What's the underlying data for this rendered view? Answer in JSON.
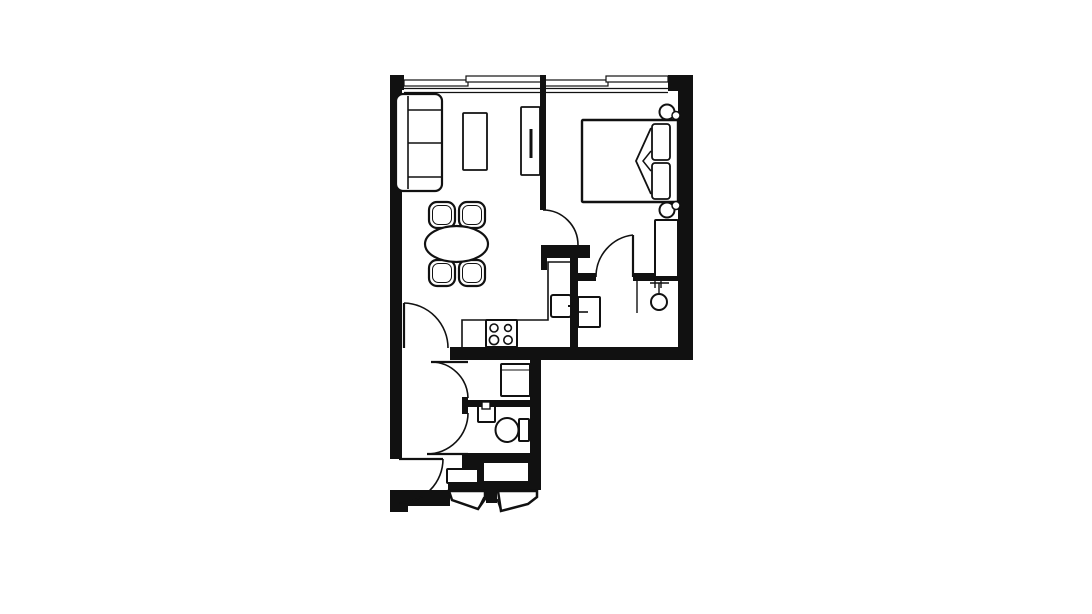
{
  "canvas": {
    "width": 1092,
    "height": 614,
    "background": "#ffffff",
    "ink": "#111111"
  },
  "plan": {
    "description": "one-bedroom apartment floor plan, black line drawing on white",
    "rooms": [
      "living-dining",
      "kitchen",
      "bedroom",
      "closet",
      "utility",
      "bathroom",
      "hall-entry"
    ],
    "elements": [
      {
        "name": "window-band",
        "t": "hole",
        "x": 404,
        "y": 75,
        "w": 264,
        "h": 18
      },
      {
        "name": "window-inner-line-1",
        "t": "line",
        "x1": 404,
        "y1": 88.5,
        "x2": 668,
        "y2": 88.5,
        "sw": 1.2
      },
      {
        "name": "window-inner-line-2",
        "t": "line",
        "x1": 404,
        "y1": 92.5,
        "x2": 668,
        "y2": 92.5,
        "sw": 1.2
      },
      {
        "name": "window-frame-living-1",
        "t": "frame",
        "x": 404,
        "y": 80,
        "w": 64,
        "h": 6,
        "sw": 1.2
      },
      {
        "name": "window-frame-living-2",
        "t": "frame",
        "x": 466,
        "y": 76,
        "w": 77,
        "h": 6,
        "sw": 1.2
      },
      {
        "name": "window-frame-bedroom-1",
        "t": "frame",
        "x": 545,
        "y": 80,
        "w": 63,
        "h": 6,
        "sw": 1.2
      },
      {
        "name": "window-frame-bedroom-2",
        "t": "frame",
        "x": 606,
        "y": 76,
        "w": 62,
        "h": 6,
        "sw": 1.2
      },
      {
        "name": "wall-top-left-corner",
        "t": "wall",
        "x": 390,
        "y": 75,
        "w": 14,
        "h": 15
      },
      {
        "name": "wall-top-right-corner",
        "t": "wall",
        "x": 668,
        "y": 75,
        "w": 25,
        "h": 16
      },
      {
        "name": "wall-left",
        "t": "wall",
        "x": 390,
        "y": 75,
        "w": 12,
        "h": 384
      },
      {
        "name": "wall-right",
        "t": "wall",
        "x": 678,
        "y": 75,
        "w": 15,
        "h": 285
      },
      {
        "name": "wall-upper-bottom",
        "t": "wall",
        "x": 450,
        "y": 347,
        "w": 243,
        "h": 13
      },
      {
        "name": "wall-room-divider",
        "t": "wall",
        "x": 540,
        "y": 75,
        "w": 6,
        "h": 135
      },
      {
        "name": "wall-kitchen-top",
        "t": "wall",
        "x": 541,
        "y": 245,
        "w": 49,
        "h": 13
      },
      {
        "name": "wall-kitchen-top-leg",
        "t": "wall",
        "x": 541,
        "y": 245,
        "w": 6,
        "h": 25
      },
      {
        "name": "wall-kitchen-partition",
        "t": "wall",
        "x": 570,
        "y": 258,
        "w": 8,
        "h": 94
      },
      {
        "name": "wall-closet-left",
        "t": "wall",
        "x": 578,
        "y": 273,
        "w": 18,
        "h": 8
      },
      {
        "name": "wall-closet-right",
        "t": "wall",
        "x": 633,
        "y": 273,
        "w": 45,
        "h": 8
      },
      {
        "name": "wall-hall-stub",
        "t": "wall",
        "x": 462,
        "y": 397,
        "w": 6,
        "h": 17
      },
      {
        "name": "wall-bath-divider",
        "t": "wall",
        "x": 468,
        "y": 400,
        "w": 62,
        "h": 7
      },
      {
        "name": "wall-bath-bottom",
        "t": "wall",
        "x": 462,
        "y": 453,
        "w": 78,
        "h": 10
      },
      {
        "name": "wall-bath-bottom-ext",
        "t": "wall",
        "x": 462,
        "y": 453,
        "w": 16,
        "h": 15
      },
      {
        "name": "wall-shaft-block",
        "t": "wall",
        "x": 476,
        "y": 453,
        "w": 64,
        "h": 37
      },
      {
        "name": "shaft-void",
        "t": "hole",
        "x": 484,
        "y": 463,
        "w": 44,
        "h": 18
      },
      {
        "name": "wall-closet-top-bar",
        "t": "wall",
        "x": 448,
        "y": 482,
        "w": 92,
        "h": 8
      },
      {
        "name": "wall-closet-divider",
        "t": "wall",
        "x": 486,
        "y": 482,
        "w": 11,
        "h": 21
      },
      {
        "name": "wall-bottom",
        "t": "wall",
        "x": 390,
        "y": 490,
        "w": 60,
        "h": 16
      },
      {
        "name": "wall-bottom-left-corner",
        "t": "wall",
        "x": 390,
        "y": 497,
        "w": 18,
        "h": 15
      },
      {
        "name": "wall-lower-right",
        "t": "wall",
        "x": 530,
        "y": 360,
        "w": 11,
        "h": 130
      },
      {
        "name": "sofa-body",
        "t": "rect",
        "x": 396,
        "y": 94,
        "w": 46,
        "h": 97,
        "r": 7,
        "sw": 2.2
      },
      {
        "name": "sofa-back-line",
        "t": "line",
        "x1": 408,
        "y1": 96,
        "x2": 408,
        "y2": 189,
        "sw": 1.6
      },
      {
        "name": "sofa-armrest-top",
        "t": "line",
        "x1": 408,
        "y1": 110,
        "x2": 441,
        "y2": 110,
        "sw": 1.6
      },
      {
        "name": "sofa-cushion-split",
        "t": "line",
        "x1": 408,
        "y1": 143,
        "x2": 441,
        "y2": 143,
        "sw": 1.6
      },
      {
        "name": "sofa-armrest-bottom",
        "t": "line",
        "x1": 408,
        "y1": 177,
        "x2": 441,
        "y2": 177,
        "sw": 1.6
      },
      {
        "name": "coffee-table",
        "t": "rect",
        "x": 463,
        "y": 113,
        "w": 24,
        "h": 57,
        "r": 1,
        "sw": 1.8
      },
      {
        "name": "tv-unit",
        "t": "rect",
        "x": 521,
        "y": 107,
        "w": 19,
        "h": 68,
        "r": 1,
        "sw": 1.8
      },
      {
        "name": "tv-screen",
        "t": "line",
        "x1": 531,
        "y1": 129,
        "x2": 531,
        "y2": 158,
        "sw": 3
      },
      {
        "name": "dining-chair-outer-tl",
        "t": "rect",
        "x": 429,
        "y": 202,
        "w": 26,
        "h": 26,
        "r": 8,
        "sw": 2.2
      },
      {
        "name": "dining-chair-inner-tl",
        "t": "rect",
        "x": 432.5,
        "y": 205.5,
        "w": 19,
        "h": 19,
        "r": 6,
        "sw": 1
      },
      {
        "name": "dining-chair-outer-tr",
        "t": "rect",
        "x": 459,
        "y": 202,
        "w": 26,
        "h": 26,
        "r": 8,
        "sw": 2.2
      },
      {
        "name": "dining-chair-inner-tr",
        "t": "rect",
        "x": 462.5,
        "y": 205.5,
        "w": 19,
        "h": 19,
        "r": 6,
        "sw": 1
      },
      {
        "name": "dining-chair-outer-bl",
        "t": "rect",
        "x": 429,
        "y": 260,
        "w": 26,
        "h": 26,
        "r": 8,
        "sw": 2.2
      },
      {
        "name": "dining-chair-inner-bl",
        "t": "rect",
        "x": 432.5,
        "y": 263.5,
        "w": 19,
        "h": 19,
        "r": 6,
        "sw": 1
      },
      {
        "name": "dining-chair-outer-br",
        "t": "rect",
        "x": 459,
        "y": 260,
        "w": 26,
        "h": 26,
        "r": 8,
        "sw": 2.2
      },
      {
        "name": "dining-chair-inner-br",
        "t": "rect",
        "x": 462.5,
        "y": 263.5,
        "w": 19,
        "h": 19,
        "r": 6,
        "sw": 1
      },
      {
        "name": "dining-table",
        "t": "ellipse",
        "cx": 456.5,
        "cy": 244,
        "rx": 31.5,
        "ry": 18,
        "sw": 2.2
      },
      {
        "name": "bed",
        "t": "rect",
        "x": 582,
        "y": 120,
        "w": 96,
        "h": 82,
        "r": 1,
        "sw": 2.4
      },
      {
        "name": "bed-pillow-top",
        "t": "rect",
        "x": 652,
        "y": 124,
        "w": 18,
        "h": 36,
        "r": 3,
        "sw": 1.8
      },
      {
        "name": "bed-pillow-bottom",
        "t": "rect",
        "x": 652,
        "y": 163,
        "w": 18,
        "h": 36,
        "r": 3,
        "sw": 1.8
      },
      {
        "name": "bed-duvet-fold",
        "t": "path",
        "d": "M651,128 L636,161 L651,194",
        "sw": 1.8
      },
      {
        "name": "bed-duvet-fold-small",
        "t": "path",
        "d": "M651,151 L643,161 L651,171",
        "sw": 1.5
      },
      {
        "name": "bedside-lamp-top",
        "t": "circle",
        "cx": 667,
        "cy": 112,
        "rx": 7.5,
        "sw": 2
      },
      {
        "name": "bedside-lamp-top-small",
        "t": "circle",
        "cx": 676,
        "cy": 115.5,
        "rx": 4,
        "sw": 1.5
      },
      {
        "name": "bedside-lamp-bottom",
        "t": "circle",
        "cx": 667,
        "cy": 210,
        "rx": 7.5,
        "sw": 2
      },
      {
        "name": "bedside-lamp-bottom-small",
        "t": "circle",
        "cx": 676,
        "cy": 205.5,
        "rx": 4,
        "sw": 1.5
      },
      {
        "name": "bedroom-dresser",
        "t": "rect",
        "x": 655,
        "y": 220,
        "w": 23,
        "h": 57,
        "r": 1,
        "sw": 2
      },
      {
        "name": "kitchen-counter-edge",
        "t": "path",
        "d": "M462,349 L462,320 L548,320 L548,262 L570,262",
        "sw": 1.6
      },
      {
        "name": "kitchen-stove",
        "t": "rect",
        "x": 486,
        "y": 320,
        "w": 31,
        "h": 27,
        "r": 1,
        "sw": 2
      },
      {
        "name": "stove-burner-tl",
        "t": "circle",
        "cx": 494,
        "cy": 328,
        "rx": 4,
        "sw": 1.6
      },
      {
        "name": "stove-burner-tr",
        "t": "circle",
        "cx": 508,
        "cy": 328,
        "rx": 3.4,
        "sw": 1.6
      },
      {
        "name": "stove-burner-bl",
        "t": "circle",
        "cx": 494,
        "cy": 340,
        "rx": 4.6,
        "sw": 1.6
      },
      {
        "name": "stove-burner-br",
        "t": "circle",
        "cx": 508,
        "cy": 340,
        "rx": 4.2,
        "sw": 1.6
      },
      {
        "name": "kitchen-sink",
        "t": "rect",
        "x": 551,
        "y": 295,
        "w": 20,
        "h": 22,
        "r": 2,
        "sw": 2
      },
      {
        "name": "kitchen-sink-tap",
        "t": "line",
        "x1": 568,
        "y1": 306,
        "x2": 576,
        "y2": 306,
        "sw": 2
      },
      {
        "name": "kitchen-sink-tap-tick",
        "t": "line",
        "x1": 572,
        "y1": 302,
        "x2": 572,
        "y2": 310,
        "sw": 1.2
      },
      {
        "name": "washing-machine",
        "t": "rect",
        "x": 578,
        "y": 297,
        "w": 22,
        "h": 30,
        "r": 1,
        "sw": 2
      },
      {
        "name": "washing-machine-handle",
        "t": "line",
        "x1": 579,
        "y1": 312,
        "x2": 588,
        "y2": 312,
        "sw": 1.6
      },
      {
        "name": "closet-jamb-line",
        "t": "line",
        "x1": 637,
        "y1": 281,
        "x2": 637,
        "y2": 313,
        "sw": 1.4
      },
      {
        "name": "closet-rail-bar",
        "t": "line",
        "x1": 650,
        "y1": 283,
        "x2": 669,
        "y2": 283,
        "sw": 1.4
      },
      {
        "name": "closet-rail-tick-1",
        "t": "line",
        "x1": 655,
        "y1": 278,
        "x2": 655,
        "y2": 288,
        "sw": 1.4
      },
      {
        "name": "closet-rail-tick-2",
        "t": "line",
        "x1": 661,
        "y1": 278,
        "x2": 661,
        "y2": 288,
        "sw": 1.4
      },
      {
        "name": "closet-rail-stem",
        "t": "line",
        "x1": 659,
        "y1": 283,
        "x2": 659,
        "y2": 294,
        "sw": 1.4
      },
      {
        "name": "closet-rail-circle",
        "t": "circle",
        "cx": 659,
        "cy": 302,
        "rx": 8,
        "sw": 2
      },
      {
        "name": "utility-appliance",
        "t": "rect",
        "x": 501,
        "y": 364,
        "w": 29,
        "h": 32,
        "r": 1,
        "sw": 2
      },
      {
        "name": "utility-appliance-line",
        "t": "line",
        "x1": 501,
        "y1": 370,
        "x2": 530,
        "y2": 370,
        "sw": 1
      },
      {
        "name": "bathroom-sink",
        "t": "rect",
        "x": 478,
        "y": 406,
        "w": 17,
        "h": 16,
        "r": 1,
        "sw": 2
      },
      {
        "name": "bathroom-sink-tap",
        "t": "frame",
        "x": 482,
        "y": 402,
        "w": 8,
        "h": 7,
        "sw": 1.4
      },
      {
        "name": "toilet-bowl",
        "t": "ellipse",
        "cx": 507,
        "cy": 430,
        "rx": 11.5,
        "ry": 12,
        "sw": 2
      },
      {
        "name": "toilet-tank",
        "t": "rect",
        "x": 519,
        "y": 419,
        "w": 10,
        "h": 22,
        "r": 1,
        "sw": 2
      },
      {
        "name": "entry-shoe-cabinet",
        "t": "rect",
        "x": 447,
        "y": 469,
        "w": 31,
        "h": 14,
        "r": 1,
        "sw": 2
      },
      {
        "name": "entry-closet-left",
        "t": "poly",
        "pts": "449,491 485,491 485,499 478,509 452,500",
        "sw": 2.5
      },
      {
        "name": "entry-closet-right",
        "t": "poly",
        "pts": "498,491 537,491 537,497 528,504 501,511",
        "sw": 2.5
      },
      {
        "name": "entry-closet-left-door",
        "t": "line",
        "x1": 478,
        "y1": 509,
        "x2": 484,
        "y2": 497,
        "sw": 1.5
      },
      {
        "name": "entry-closet-right-door",
        "t": "line",
        "x1": 501,
        "y1": 511,
        "x2": 497,
        "y2": 499,
        "sw": 1.5
      },
      {
        "name": "door-bedroom-arc",
        "t": "path",
        "d": "M543,210 A35,35 0 0 1 578,245",
        "sw": 1.6
      },
      {
        "name": "door-closet-leaf",
        "t": "line",
        "x1": 633,
        "y1": 235,
        "x2": 633,
        "y2": 277,
        "sw": 2.2
      },
      {
        "name": "door-closet-arc",
        "t": "path",
        "d": "M633,235 A42,42 0 0 0 596,277",
        "sw": 1.6
      },
      {
        "name": "door-hall-leaf",
        "t": "line",
        "x1": 404,
        "y1": 303,
        "x2": 404,
        "y2": 348,
        "sw": 2.2
      },
      {
        "name": "door-hall-arc",
        "t": "path",
        "d": "M404,303 A45,45 0 0 1 448,348",
        "sw": 1.6
      },
      {
        "name": "door-utility-leaf",
        "t": "line",
        "x1": 431,
        "y1": 362,
        "x2": 468,
        "y2": 362,
        "sw": 2.2
      },
      {
        "name": "door-utility-arc",
        "t": "path",
        "d": "M431,362 A37,37 0 0 1 468,398",
        "sw": 1.6
      },
      {
        "name": "door-bathroom-leaf",
        "t": "line",
        "x1": 427,
        "y1": 454,
        "x2": 468,
        "y2": 454,
        "sw": 2.2
      },
      {
        "name": "door-bathroom-arc",
        "t": "path",
        "d": "M427,454 A41,41 0 0 0 468,413",
        "sw": 1.6
      },
      {
        "name": "door-entry-leaf",
        "t": "line",
        "x1": 399,
        "y1": 459,
        "x2": 443,
        "y2": 459,
        "sw": 2.2
      },
      {
        "name": "door-entry-arc",
        "t": "path",
        "d": "M443,459 A44,44 0 0 1 399,503",
        "sw": 1.6
      }
    ]
  }
}
